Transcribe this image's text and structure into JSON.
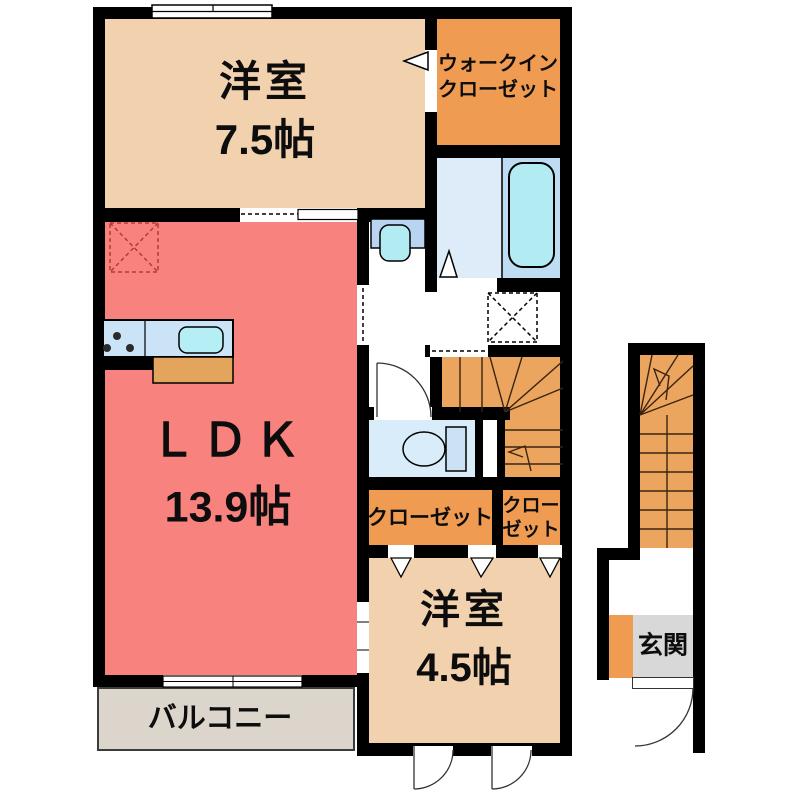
{
  "rooms": {
    "bedroom_main": {
      "label": "洋室",
      "area": "7.5帖"
    },
    "walk_in_closet": {
      "line1": "ウォークイン",
      "line2": "クローゼット"
    },
    "ldk": {
      "label": "ＬＤＫ",
      "area": "13.9帖"
    },
    "hall_closet": {
      "label": "クローゼット"
    },
    "small_closet": {
      "line1": "クロー",
      "line2": "ゼット"
    },
    "bedroom_second": {
      "label": "洋室",
      "area": "4.5帖"
    },
    "balcony": {
      "label": "バルコニー"
    },
    "entrance": {
      "label": "玄関"
    }
  },
  "colors": {
    "wall": "#000000",
    "bedroom_beige": "#f2d2ae",
    "closet_orange": "#ef9b51",
    "ldk_salmon": "#f8827e",
    "stairs_orange": "#eba55e",
    "bath_washing_area": "#ddecf8",
    "bath_tub_area": "#bedcf2",
    "tub_water": "#b2ebf2",
    "toilet_room_blue": "#d9ecfa",
    "fixture_blue": "#cde1f5",
    "kitchen_counter_blue": "#cbe3f7",
    "sink_cyan": "#b6eef6",
    "counter_wood": "#e3a55e",
    "balcony_gray": "#dcd5cb",
    "entrance_floor_gray": "#d8d8d8",
    "hatch_red": "#b53a32"
  },
  "fixtures": {
    "bathtub": "bathtub-icon",
    "toilet": "toilet-icon",
    "washbasin": "washbasin-icon",
    "stove": "stove-burners-icon",
    "kitchen_sink": "kitchen-sink-icon",
    "stairs_internal": "staircase-internal-icon",
    "stairs_external": "staircase-external-icon",
    "entrance_door": "door-arc-icon",
    "window": "sliding-window-icon"
  }
}
